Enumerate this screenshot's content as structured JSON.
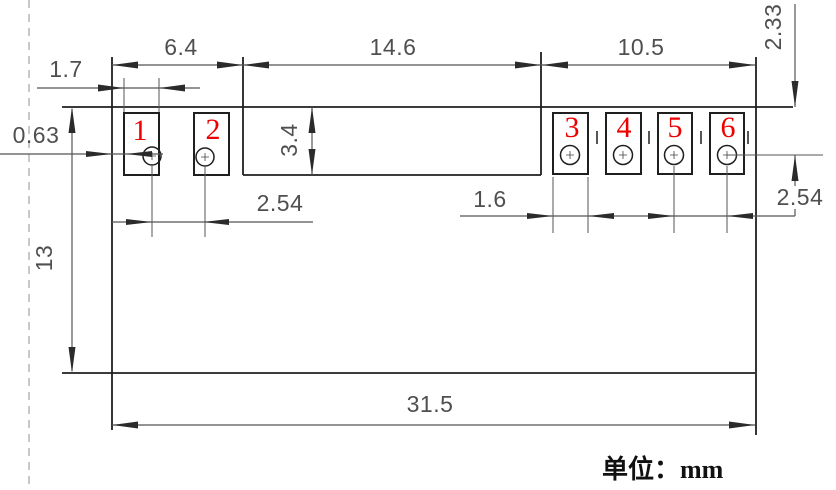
{
  "drawing_type": "mechanical dimension drawing (top view of sensor module PCB with 6 pads)",
  "unit_note": "单位：mm",
  "pad_numbers": [
    "1",
    "2",
    "3",
    "4",
    "5",
    "6"
  ],
  "dimensions": {
    "left_pads_section_width": "6.4",
    "middle_section_width": "14.6",
    "right_pads_section_width": "10.5",
    "left_pad_width": "1.7",
    "left_edge_to_pad_gap": "0.63",
    "middle_section_height": "3.4",
    "top_edge_to_hole_row": "2.33",
    "board_height": "13",
    "left_pads_pitch": "2.54",
    "right_pad_width": "1.6",
    "right_pads_pitch": "2.54",
    "board_width": "31.5"
  },
  "colors": {
    "pad_number_red": "#ee0000",
    "object_line": "#1f1f1f",
    "dimension_line": "#555555",
    "dashed_guide": "#b5b5b5",
    "background": "#ffffff"
  }
}
